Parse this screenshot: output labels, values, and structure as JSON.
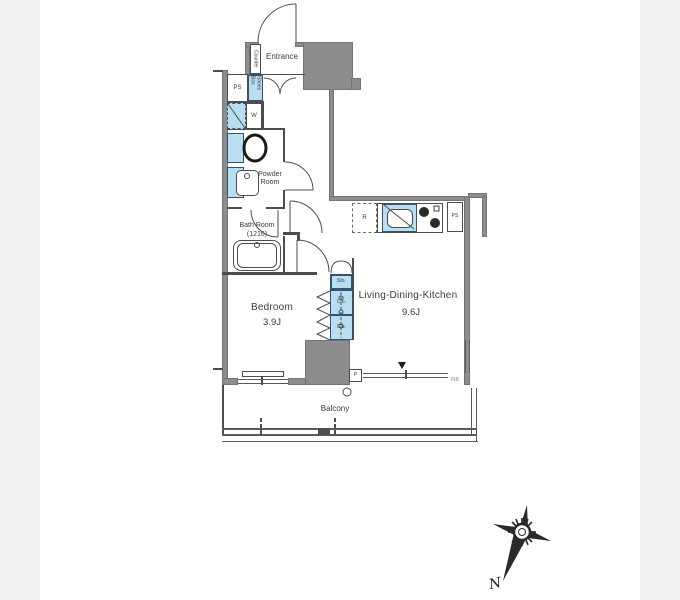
{
  "page": {
    "background": "#f0f0f0",
    "paper_background": "#ffffff"
  },
  "plan": {
    "entrance": {
      "label": "Entrance",
      "counter": "Counter",
      "shoes_box": "Shoes Box"
    },
    "utilities": {
      "ps_upper": "PS",
      "washer": "W",
      "fridge": "R",
      "ps_kitchen": "PS",
      "pipe": "P"
    },
    "rooms": {
      "powder_room": {
        "name": "Powder Room"
      },
      "bath_room": {
        "name": "Bath Room",
        "size": "(1216)"
      },
      "bedroom": {
        "name": "Bedroom",
        "size": "3.9J"
      },
      "ldk": {
        "name": "Living-Dining-Kitchen",
        "size": "9.6J"
      },
      "balcony": {
        "name": "Balcony"
      }
    },
    "storage": {
      "sto": "Sto.",
      "clo_upper": "Clo.",
      "clo_lower": "Clo."
    },
    "windows": {
      "fix": "FIX"
    },
    "compass": {
      "north": "N"
    },
    "colors": {
      "fixture_blue": "#b9ddf1",
      "fixture_border": "#33536b",
      "wall_gray": "#8d8d8d",
      "line_dark": "#4d4d4d"
    }
  }
}
